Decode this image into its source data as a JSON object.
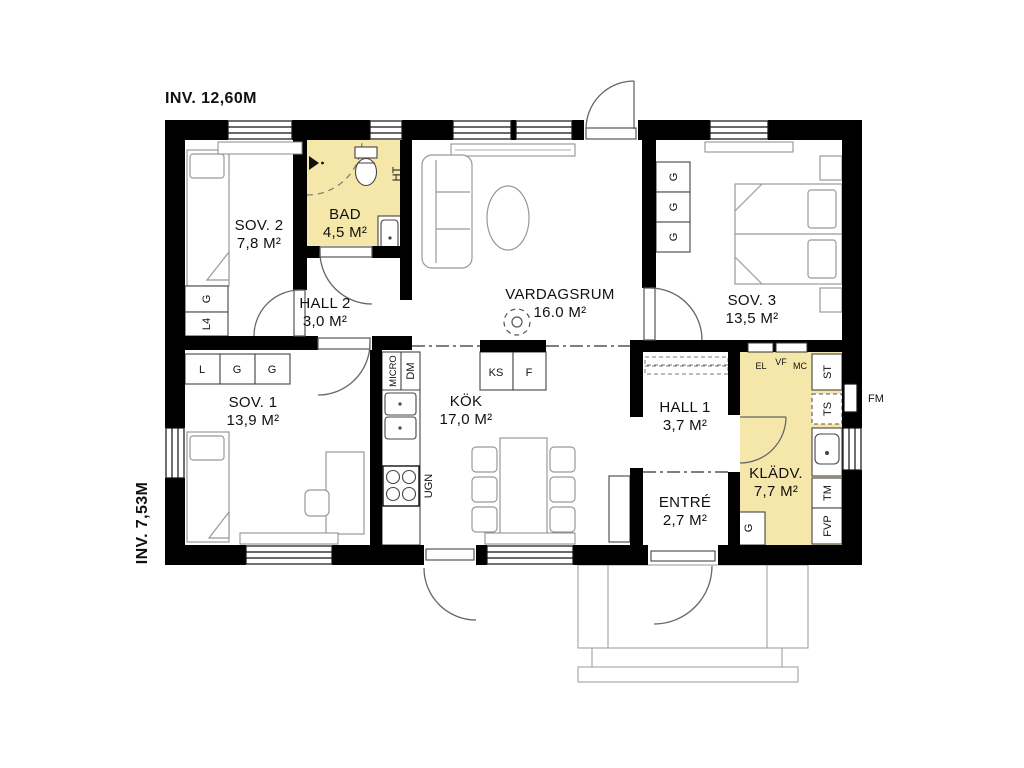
{
  "annotations": {
    "inv_top": "INV. 12,60M",
    "inv_left": "INV. 7,53M",
    "fm": "FM"
  },
  "rooms": {
    "sov2": {
      "name": "SOV. 2",
      "area": "7,8 M²"
    },
    "bad": {
      "name": "BAD",
      "area": "4,5 M²"
    },
    "hall2": {
      "name": "HALL 2",
      "area": "3,0 M²"
    },
    "vardagsrum": {
      "name": "VARDAGSRUM",
      "area": "16.0 M²"
    },
    "sov3": {
      "name": "SOV. 3",
      "area": "13,5 M²"
    },
    "sov1": {
      "name": "SOV. 1",
      "area": "13,9 M²"
    },
    "kok": {
      "name": "KÖK",
      "area": "17,0 M²"
    },
    "hall1": {
      "name": "HALL 1",
      "area": "3,7 M²"
    },
    "entre": {
      "name": "ENTRÉ",
      "area": "2,7 M²"
    },
    "kladv": {
      "name": "KLÄDV.",
      "area": "7,7 M²"
    }
  },
  "fixtures": {
    "sov2_g": "G",
    "sov2_l4": "L4",
    "sov1_l": "L",
    "sov1_g1": "G",
    "sov1_g2": "G",
    "sov3_g1": "G",
    "sov3_g2": "G",
    "sov3_g3": "G",
    "bad_ht": "HT",
    "kok_micro": "MICRO",
    "kok_dm": "DM",
    "kok_ks": "KS",
    "kok_f": "F",
    "kok_ugn": "UGN",
    "kladv_el": "EL",
    "kladv_vf": "VF",
    "kladv_mc": "MC",
    "kladv_st": "ST",
    "kladv_ts": "TS",
    "kladv_tm": "TM",
    "kladv_fvp": "FVP",
    "kladv_g": "G"
  },
  "colors": {
    "wall": "#000000",
    "accent_room": "#F5E7A9",
    "furniture_line": "#999999"
  }
}
